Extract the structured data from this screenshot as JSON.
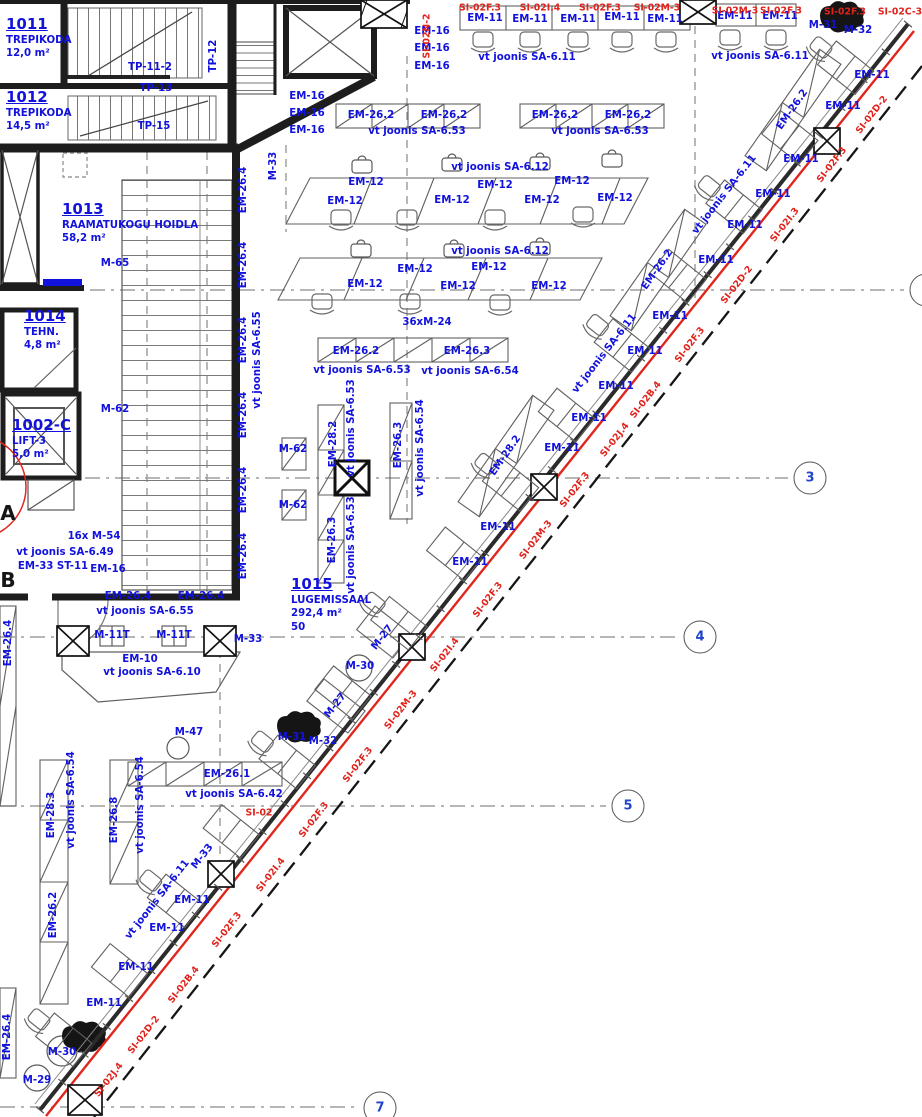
{
  "plan": {
    "colors": {
      "label_blue": "#1212dd",
      "label_red": "#e0231b",
      "wall": "#1d1d1d",
      "furniture": "#666666",
      "grid_number": "#2244cc"
    },
    "rooms": [
      {
        "number": "1011",
        "name": "TREPIKODA",
        "area": "12,0 m²",
        "x": 6,
        "y": 16
      },
      {
        "number": "1012",
        "name": "TREPIKODA",
        "area": "14,5 m²",
        "x": 6,
        "y": 89
      },
      {
        "number": "1013",
        "name": "RAAMATUKOGU HOIDLA",
        "area": "58,2 m²",
        "x": 62,
        "y": 201
      },
      {
        "number": "1014",
        "name": "TEHN.",
        "area": "4,8 m²",
        "x": 24,
        "y": 308
      },
      {
        "number": "1002-C",
        "name": "LIFT-3",
        "area": "5,0 m²",
        "x": 12,
        "y": 417
      },
      {
        "number": "1015",
        "name": "LUGEMISSAAL",
        "area": "292,4 m²",
        "extra": "50",
        "x": 291,
        "y": 576
      }
    ],
    "grid_bubbles": [
      {
        "label": "3",
        "x": 810,
        "y": 478
      },
      {
        "label": "4",
        "x": 700,
        "y": 637
      },
      {
        "label": "5",
        "x": 628,
        "y": 806
      },
      {
        "label": "7",
        "x": 380,
        "y": 1108
      },
      {
        "label": "",
        "x": 926,
        "y": 290
      }
    ],
    "grid_letters": [
      {
        "label": "A",
        "x": 8,
        "y": 513
      },
      {
        "label": "B",
        "x": 8,
        "y": 580
      }
    ],
    "columns": [
      {
        "x": 384,
        "y": 14,
        "w": 46,
        "h": 28,
        "hatch": true
      },
      {
        "x": 698,
        "y": 12,
        "w": 36,
        "h": 24
      },
      {
        "x": 827,
        "y": 141,
        "w": 26,
        "h": 26
      },
      {
        "x": 352,
        "y": 478,
        "w": 34,
        "h": 34,
        "bold": true
      },
      {
        "x": 544,
        "y": 487,
        "w": 26,
        "h": 26
      },
      {
        "x": 412,
        "y": 647,
        "w": 26,
        "h": 26
      },
      {
        "x": 221,
        "y": 874,
        "w": 26,
        "h": 26
      },
      {
        "x": 85,
        "y": 1100,
        "w": 34,
        "h": 30
      },
      {
        "x": 73,
        "y": 641,
        "w": 32,
        "h": 30
      },
      {
        "x": 220,
        "y": 641,
        "w": 32,
        "h": 30
      }
    ],
    "curtain_wall": {
      "wall_line": {
        "x1": 908,
        "y1": 24,
        "x2": 40,
        "y2": 1110
      },
      "desk_line": {
        "x1": 866,
        "y1": 84,
        "x2": 84,
        "y2": 1056
      },
      "desk_count": 15,
      "tick_count": 40
    },
    "labels": [
      {
        "t": "TP-11-2",
        "x": 150,
        "y": 68
      },
      {
        "t": "TP-13",
        "x": 156,
        "y": 89
      },
      {
        "t": "TP-15",
        "x": 154,
        "y": 127
      },
      {
        "t": "TP-12",
        "x": 214,
        "y": 56,
        "r": -90
      },
      {
        "t": "M-33",
        "x": 274,
        "y": 166,
        "r": -90
      },
      {
        "t": "EM-16",
        "x": 307,
        "y": 97
      },
      {
        "t": "EM-16",
        "x": 307,
        "y": 114
      },
      {
        "t": "EM-16",
        "x": 307,
        "y": 131
      },
      {
        "t": "EM-16",
        "x": 432,
        "y": 32
      },
      {
        "t": "EM-16",
        "x": 432,
        "y": 49
      },
      {
        "t": "EM-16",
        "x": 432,
        "y": 67
      },
      {
        "t": "EM-11",
        "x": 485,
        "y": 19
      },
      {
        "t": "EM-11",
        "x": 530,
        "y": 20
      },
      {
        "t": "EM-11",
        "x": 578,
        "y": 20
      },
      {
        "t": "EM-11",
        "x": 622,
        "y": 18
      },
      {
        "t": "EM-11",
        "x": 665,
        "y": 20
      },
      {
        "t": "EM-11",
        "x": 735,
        "y": 17
      },
      {
        "t": "EM-11",
        "x": 780,
        "y": 17
      },
      {
        "t": "vt joonis SA-6.11",
        "x": 527,
        "y": 58
      },
      {
        "t": "vt joonis SA-6.11",
        "x": 760,
        "y": 57
      },
      {
        "t": "M-31",
        "x": 823,
        "y": 26
      },
      {
        "t": "M-32",
        "x": 858,
        "y": 31
      },
      {
        "t": "EM-26.2",
        "x": 371,
        "y": 116
      },
      {
        "t": "EM-26.2",
        "x": 444,
        "y": 116
      },
      {
        "t": "EM-26.2",
        "x": 555,
        "y": 116
      },
      {
        "t": "EM-26.2",
        "x": 628,
        "y": 116
      },
      {
        "t": "vt joonis SA-6.53",
        "x": 417,
        "y": 132
      },
      {
        "t": "vt joonis SA-6.53",
        "x": 600,
        "y": 132
      },
      {
        "t": "EM-26.2",
        "x": 793,
        "y": 110,
        "r": -55
      },
      {
        "t": "EM-26.2",
        "x": 658,
        "y": 270,
        "r": -55
      },
      {
        "t": "EM-28.2",
        "x": 506,
        "y": 456,
        "r": -55
      },
      {
        "t": "vt joonis SA-6.12",
        "x": 500,
        "y": 168
      },
      {
        "t": "vt joonis SA-6.12",
        "x": 500,
        "y": 252
      },
      {
        "t": "EM-12",
        "x": 366,
        "y": 183
      },
      {
        "t": "EM-12",
        "x": 495,
        "y": 186
      },
      {
        "t": "EM-12",
        "x": 572,
        "y": 182
      },
      {
        "t": "EM-12",
        "x": 345,
        "y": 202
      },
      {
        "t": "EM-12",
        "x": 452,
        "y": 201
      },
      {
        "t": "EM-12",
        "x": 542,
        "y": 201
      },
      {
        "t": "EM-12",
        "x": 615,
        "y": 199
      },
      {
        "t": "EM-12",
        "x": 415,
        "y": 270
      },
      {
        "t": "EM-12",
        "x": 489,
        "y": 268
      },
      {
        "t": "EM-12",
        "x": 365,
        "y": 285
      },
      {
        "t": "EM-12",
        "x": 458,
        "y": 287
      },
      {
        "t": "EM-12",
        "x": 549,
        "y": 287
      },
      {
        "t": "36xM-24",
        "x": 427,
        "y": 323
      },
      {
        "t": "EM-26.2",
        "x": 356,
        "y": 352
      },
      {
        "t": "EM-26.3",
        "x": 467,
        "y": 352
      },
      {
        "t": "vt joonis SA-6.53",
        "x": 362,
        "y": 371
      },
      {
        "t": "vt joonis SA-6.54",
        "x": 470,
        "y": 372
      },
      {
        "t": "EM-28.2",
        "x": 334,
        "y": 444,
        "r": -90
      },
      {
        "t": "vt joonis SA-6.53",
        "x": 352,
        "y": 428,
        "r": -90
      },
      {
        "t": "EM-26.3",
        "x": 333,
        "y": 540,
        "r": -90
      },
      {
        "t": "vt joonis SA-6.53",
        "x": 352,
        "y": 545,
        "r": -90
      },
      {
        "t": "EM-26.3",
        "x": 399,
        "y": 445,
        "r": -90
      },
      {
        "t": "vt joonis SA-6.54",
        "x": 421,
        "y": 448,
        "r": -90
      },
      {
        "t": "M-65",
        "x": 115,
        "y": 264
      },
      {
        "t": "M-62",
        "x": 115,
        "y": 410
      },
      {
        "t": "M-62",
        "x": 293,
        "y": 450
      },
      {
        "t": "M-62",
        "x": 293,
        "y": 506
      },
      {
        "t": "16x M-54",
        "x": 94,
        "y": 537
      },
      {
        "t": "vt joonis SA-6.49",
        "x": 65,
        "y": 553
      },
      {
        "t": "EM-33 ST-11",
        "x": 53,
        "y": 567
      },
      {
        "t": "EM-16",
        "x": 108,
        "y": 570
      },
      {
        "t": "EM-26.4",
        "x": 244,
        "y": 190,
        "r": -90
      },
      {
        "t": "EM-26.4",
        "x": 244,
        "y": 265,
        "r": -90
      },
      {
        "t": "EM-26.4",
        "x": 244,
        "y": 340,
        "r": -90
      },
      {
        "t": "EM-26.4",
        "x": 244,
        "y": 415,
        "r": -90
      },
      {
        "t": "EM-26.4",
        "x": 244,
        "y": 490,
        "r": -90
      },
      {
        "t": "EM-26.4",
        "x": 244,
        "y": 556,
        "r": -90
      },
      {
        "t": "vt joonis SA-6.55",
        "x": 258,
        "y": 360,
        "r": -90
      },
      {
        "t": "EM-26.4",
        "x": 128,
        "y": 597
      },
      {
        "t": "EM-26.4",
        "x": 201,
        "y": 597
      },
      {
        "t": "vt joonis SA-6.55",
        "x": 145,
        "y": 612
      },
      {
        "t": "M-11T",
        "x": 112,
        "y": 636
      },
      {
        "t": "M-11T",
        "x": 174,
        "y": 636
      },
      {
        "t": "M-33",
        "x": 248,
        "y": 640
      },
      {
        "t": "EM-10",
        "x": 140,
        "y": 660
      },
      {
        "t": "vt joonis SA-6.10",
        "x": 152,
        "y": 673
      },
      {
        "t": "EM-26.4",
        "x": 9,
        "y": 643,
        "r": -90
      },
      {
        "t": "EM-26.4",
        "x": 8,
        "y": 1037,
        "r": -90
      },
      {
        "t": "M-47",
        "x": 189,
        "y": 733
      },
      {
        "t": "M-31",
        "x": 292,
        "y": 738
      },
      {
        "t": "M-32",
        "x": 323,
        "y": 742
      },
      {
        "t": "M-27",
        "x": 383,
        "y": 638,
        "r": -52
      },
      {
        "t": "M-27",
        "x": 336,
        "y": 706,
        "r": -52
      },
      {
        "t": "M-30",
        "x": 360,
        "y": 667
      },
      {
        "t": "EM-26.1",
        "x": 227,
        "y": 775
      },
      {
        "t": "vt joonis SA-6.42",
        "x": 234,
        "y": 795
      },
      {
        "t": "EM-28.3",
        "x": 52,
        "y": 815,
        "r": -90
      },
      {
        "t": "vt joonis SA-6.54",
        "x": 72,
        "y": 800,
        "r": -90
      },
      {
        "t": "EM-26.8",
        "x": 115,
        "y": 820,
        "r": -90
      },
      {
        "t": "vt joonis SA-6.54",
        "x": 141,
        "y": 805,
        "r": -90
      },
      {
        "t": "EM-26.2",
        "x": 54,
        "y": 915,
        "r": -90
      },
      {
        "t": "vt joonis SA-6.11",
        "x": 158,
        "y": 900,
        "r": -52
      },
      {
        "t": "M-33",
        "x": 203,
        "y": 857,
        "r": -52
      },
      {
        "t": "EM-11",
        "x": 192,
        "y": 901
      },
      {
        "t": "EM-11",
        "x": 167,
        "y": 929
      },
      {
        "t": "EM-11",
        "x": 136,
        "y": 968
      },
      {
        "t": "EM-11",
        "x": 104,
        "y": 1004
      },
      {
        "t": "M-30",
        "x": 62,
        "y": 1053
      },
      {
        "t": "M-29",
        "x": 37,
        "y": 1081
      },
      {
        "t": "EM-11",
        "x": 872,
        "y": 76
      },
      {
        "t": "EM-11",
        "x": 843,
        "y": 107
      },
      {
        "t": "EM-11",
        "x": 801,
        "y": 160
      },
      {
        "t": "EM-11",
        "x": 773,
        "y": 195
      },
      {
        "t": "EM-11",
        "x": 745,
        "y": 226
      },
      {
        "t": "EM-11",
        "x": 716,
        "y": 261
      },
      {
        "t": "EM-11",
        "x": 670,
        "y": 317
      },
      {
        "t": "EM-11",
        "x": 645,
        "y": 352
      },
      {
        "t": "EM-11",
        "x": 616,
        "y": 387
      },
      {
        "t": "EM-11",
        "x": 589,
        "y": 419
      },
      {
        "t": "EM-11",
        "x": 562,
        "y": 449
      },
      {
        "t": "EM-11",
        "x": 498,
        "y": 528
      },
      {
        "t": "EM-11",
        "x": 470,
        "y": 563
      },
      {
        "t": "vt joonis SA-6.11",
        "x": 725,
        "y": 195,
        "r": -52
      },
      {
        "t": "vt joonis SA-6.11",
        "x": 605,
        "y": 354,
        "r": -52
      },
      {
        "t": "SI-02F.3",
        "x": 480,
        "y": 8,
        "c": "red"
      },
      {
        "t": "SI-02I.4",
        "x": 540,
        "y": 8,
        "c": "red"
      },
      {
        "t": "SI-02F.3",
        "x": 600,
        "y": 8,
        "c": "red"
      },
      {
        "t": "SI-02M-3",
        "x": 657,
        "y": 8,
        "c": "red"
      },
      {
        "t": "SI-02M-3",
        "x": 735,
        "y": 11,
        "c": "red"
      },
      {
        "t": "SI-02F.3",
        "x": 781,
        "y": 11,
        "c": "red"
      },
      {
        "t": "SI-02F.3",
        "x": 845,
        "y": 12,
        "c": "red"
      },
      {
        "t": "SI-02C-3",
        "x": 900,
        "y": 12,
        "c": "red"
      },
      {
        "t": "SI-02N-2",
        "x": 427,
        "y": 36,
        "r": -90,
        "c": "red"
      },
      {
        "t": "SI-02",
        "x": 259,
        "y": 813,
        "c": "red"
      },
      {
        "t": "SI-02D-2",
        "x": 872,
        "y": 115,
        "r": -52,
        "c": "red"
      },
      {
        "t": "SI-02F.3",
        "x": 832,
        "y": 165,
        "r": -52,
        "c": "red"
      },
      {
        "t": "SI-02I.3",
        "x": 785,
        "y": 225,
        "r": -52,
        "c": "red"
      },
      {
        "t": "SI-02D-2",
        "x": 737,
        "y": 285,
        "r": -52,
        "c": "red"
      },
      {
        "t": "SI-02F.3",
        "x": 690,
        "y": 345,
        "r": -52,
        "c": "red"
      },
      {
        "t": "SI-02B.4",
        "x": 646,
        "y": 400,
        "r": -52,
        "c": "red"
      },
      {
        "t": "SI-02J.4",
        "x": 615,
        "y": 440,
        "r": -52,
        "c": "red"
      },
      {
        "t": "SI-02F.3",
        "x": 575,
        "y": 490,
        "r": -52,
        "c": "red"
      },
      {
        "t": "SI-02M-3",
        "x": 536,
        "y": 540,
        "r": -52,
        "c": "red"
      },
      {
        "t": "SI-02F.3",
        "x": 488,
        "y": 600,
        "r": -52,
        "c": "red"
      },
      {
        "t": "SI-02I.4",
        "x": 445,
        "y": 655,
        "r": -52,
        "c": "red"
      },
      {
        "t": "SI-02M-3",
        "x": 401,
        "y": 710,
        "r": -52,
        "c": "red"
      },
      {
        "t": "SI-02F.3",
        "x": 358,
        "y": 765,
        "r": -52,
        "c": "red"
      },
      {
        "t": "SI-02F.3",
        "x": 314,
        "y": 820,
        "r": -52,
        "c": "red"
      },
      {
        "t": "SI-02I.4",
        "x": 271,
        "y": 875,
        "r": -52,
        "c": "red"
      },
      {
        "t": "SI-02F.3",
        "x": 227,
        "y": 930,
        "r": -52,
        "c": "red"
      },
      {
        "t": "SI-02B.4",
        "x": 184,
        "y": 985,
        "r": -52,
        "c": "red"
      },
      {
        "t": "SI-02D-2",
        "x": 144,
        "y": 1035,
        "r": -52,
        "c": "red"
      },
      {
        "t": "SI-02J.4",
        "x": 109,
        "y": 1080,
        "r": -52,
        "c": "red"
      }
    ]
  }
}
